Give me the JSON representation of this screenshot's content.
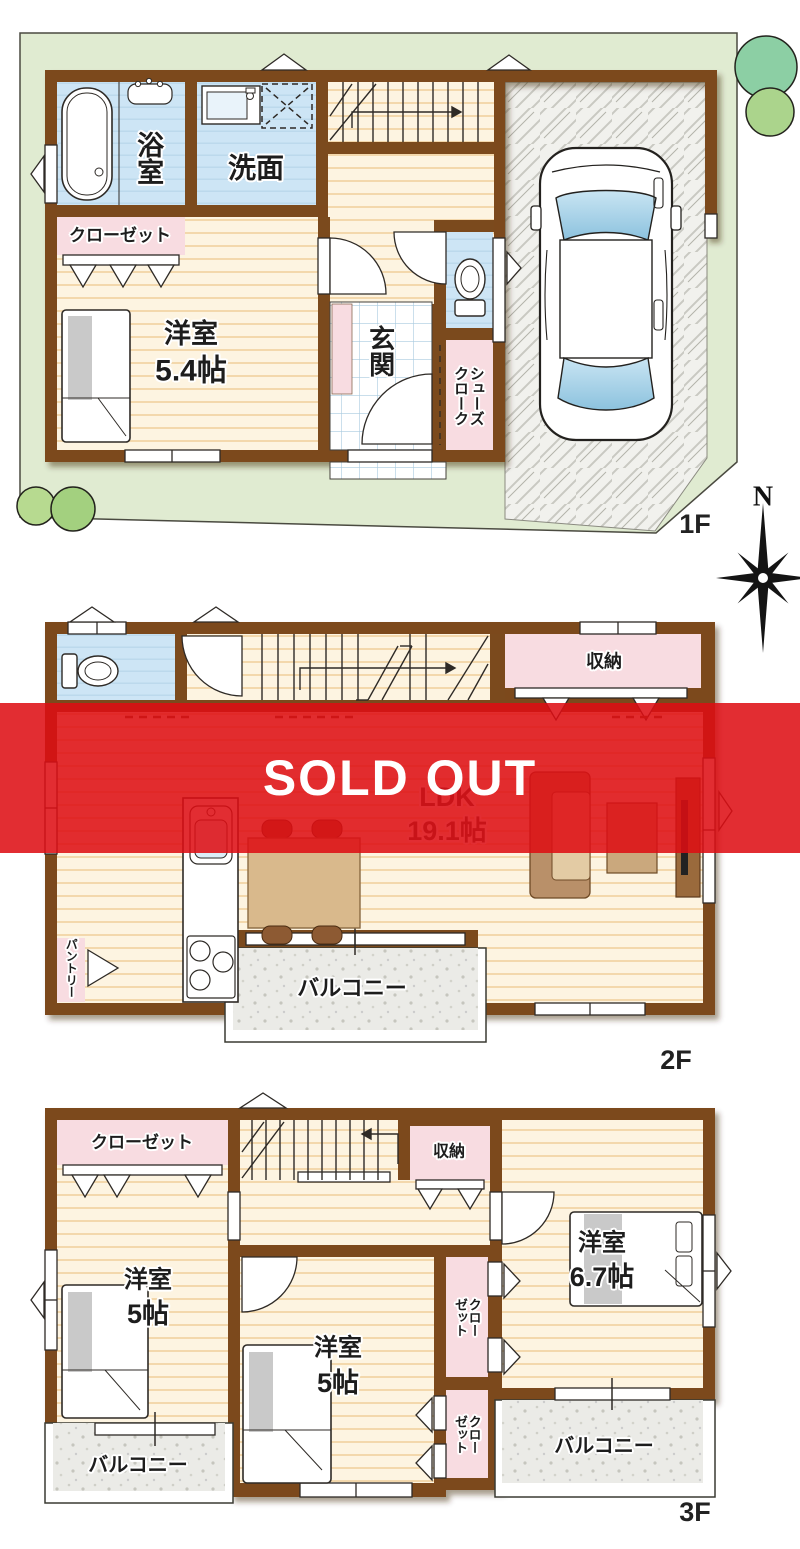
{
  "banner": {
    "text": "SOLD OUT",
    "color": "#de0e14"
  },
  "compass": {
    "north": "N"
  },
  "floor1": {
    "label": "1F",
    "bathroom": "浴室",
    "washroom": "洗面",
    "closet": "クローゼット",
    "bedroom_name": "洋室",
    "bedroom_size": "5.4帖",
    "entrance": "玄関",
    "shoes_cloak": "シューズクローク"
  },
  "floor2": {
    "label": "2F",
    "storage": "収納",
    "ldk_name": "LDK",
    "ldk_size": "19.1帖",
    "balcony": "バルコニー",
    "pantry": "パントリー"
  },
  "floor3": {
    "label": "3F",
    "closet_top": "クローゼット",
    "storage": "収納",
    "bedroom_left_name": "洋室",
    "bedroom_left_size": "5帖",
    "bedroom_mid_name": "洋室",
    "bedroom_mid_size": "5帖",
    "bedroom_right_name": "洋室",
    "bedroom_right_size": "6.7帖",
    "closet_mid": "クローゼット",
    "closet_low": "クローゼット",
    "balcony_left": "バルコニー",
    "balcony_right": "バルコニー"
  }
}
